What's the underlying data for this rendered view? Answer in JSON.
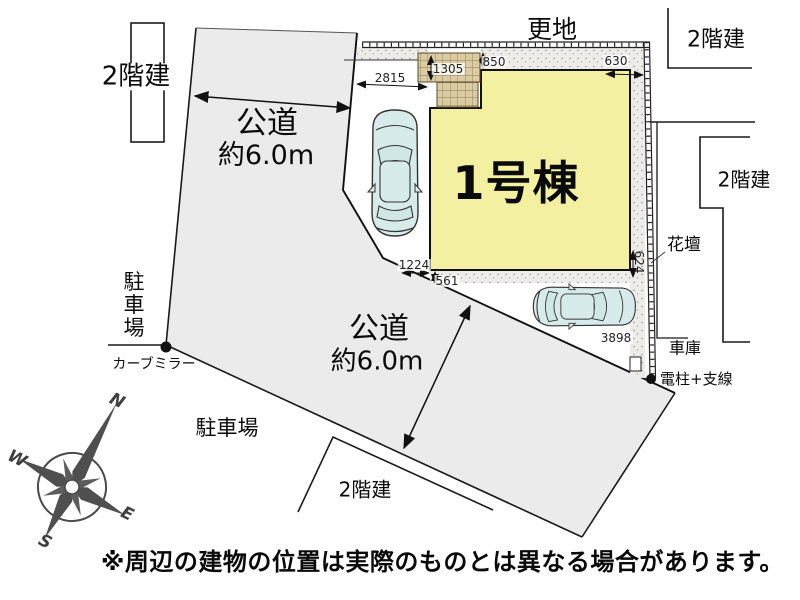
{
  "plan": {
    "building_label": "1号棟",
    "vacant_land": "更地",
    "neighbors": {
      "top_left": "2階建",
      "top_right": "2階建",
      "mid_right": "2階建",
      "bottom": "2階建"
    },
    "roads": {
      "west": {
        "name": "公道",
        "width": "約6.0m"
      },
      "south": {
        "name": "公道",
        "width": "約6.0m"
      }
    },
    "features": {
      "parking_west": "駐車場",
      "parking_south": "駐車場",
      "curve_mirror": "カーブミラー",
      "flower_bed": "花壇",
      "garage": "車庫",
      "utility_pole": "電柱+支線"
    },
    "dimensions": {
      "west_frontage": "2815",
      "porch_depth": "1305",
      "north_setback": "850",
      "northeast_setback": "630",
      "east_setback": "624",
      "southwest": "1224",
      "south_setback": "561",
      "car_space_length": "3898"
    },
    "compass": {
      "n": "N",
      "e": "E",
      "s": "S",
      "w": "W"
    },
    "disclaimer": "※周辺の建物の位置は実際のものとは異なる場合があります。",
    "colors": {
      "building": "#f3f0a2",
      "road": "#ebebeb",
      "car": "#d7ecea",
      "hatch": "#dbcba2"
    }
  }
}
